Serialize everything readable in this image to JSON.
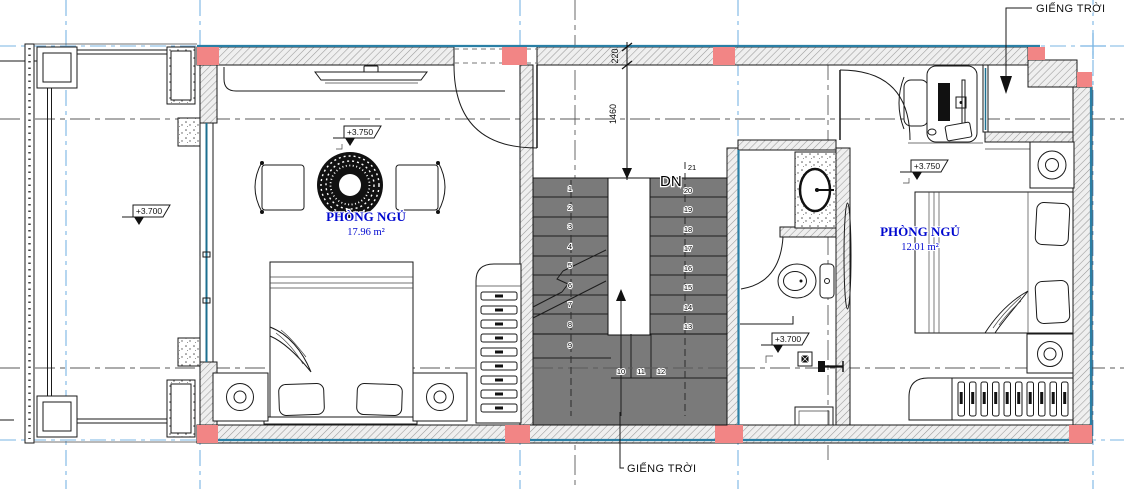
{
  "plan": {
    "skylight_label_top": "GIẾNG TRỜI",
    "skylight_label_bottom": "GIẾNG TRỜI",
    "stair_direction_label": "DN",
    "rooms": {
      "bedroom_left": {
        "name": "PHÒNG NGỦ",
        "area": "17.96 m²",
        "level": "+3.750"
      },
      "bedroom_right": {
        "name": "PHÒNG NGỦ",
        "area": "12.01 m²",
        "level": "+3.750"
      },
      "balcony": {
        "level": "+3.700"
      },
      "bathroom": {
        "level": "+3.700"
      }
    },
    "dimensions": {
      "wall_thickness": "220",
      "hall_depth": "1460"
    },
    "stairs": {
      "steps": [
        "1",
        "2",
        "3",
        "4",
        "5",
        "6",
        "7",
        "8",
        "9",
        "10",
        "11",
        "12",
        "13",
        "14",
        "15",
        "16",
        "17",
        "18",
        "19",
        "20",
        "21"
      ]
    },
    "colors": {
      "gridline": "#79b5e3",
      "column": "#f28585",
      "stair_tread": "#7a7a7a",
      "room_label": "#0008cf",
      "wall_edge": "#2a7fa5"
    }
  }
}
